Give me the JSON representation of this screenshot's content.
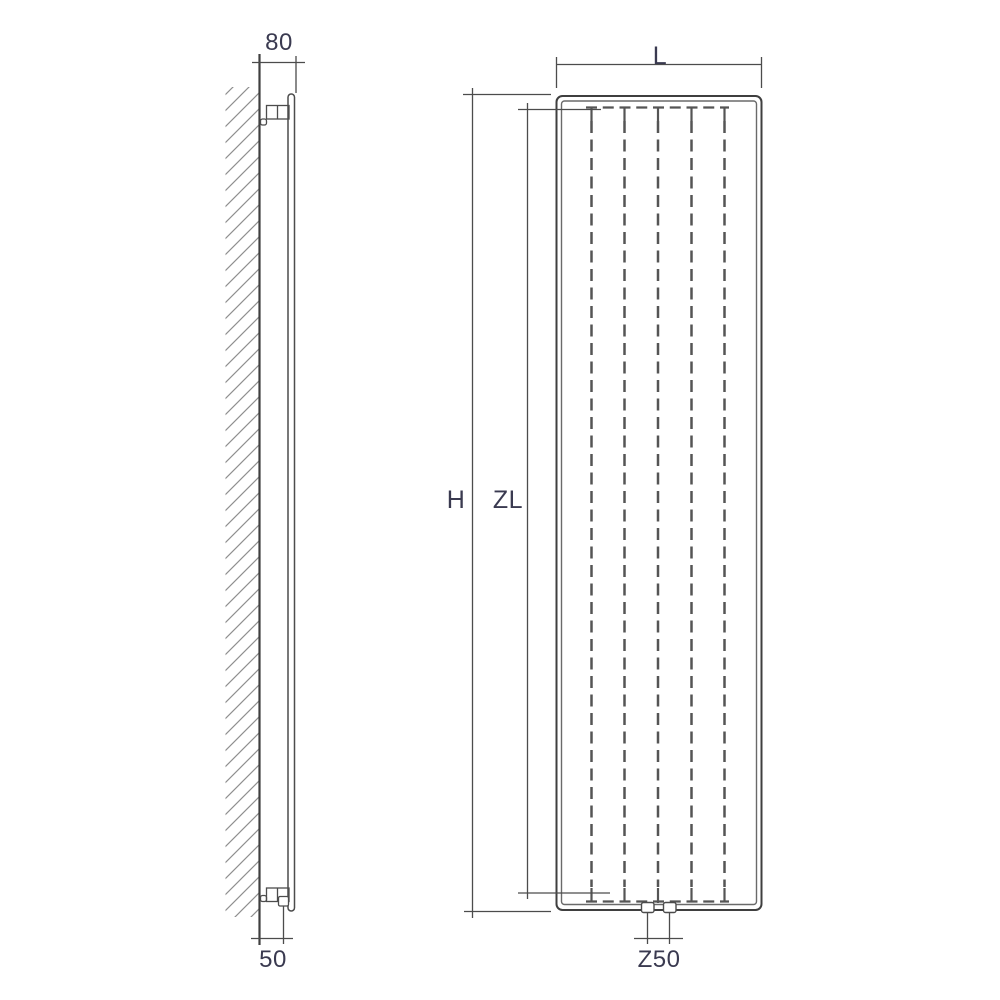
{
  "drawing": {
    "dimensions": {
      "wall_to_front": "80",
      "wall_to_connection": "50",
      "width": "L",
      "height": "H",
      "element_length": "ZL",
      "connection_centers": "Z50"
    },
    "colors": {
      "line": "#4c4c4c",
      "line_dark": "#3f3f3f",
      "hatch": "#8f8f8f",
      "text": "#3a3a50",
      "background": "#ffffff"
    }
  }
}
